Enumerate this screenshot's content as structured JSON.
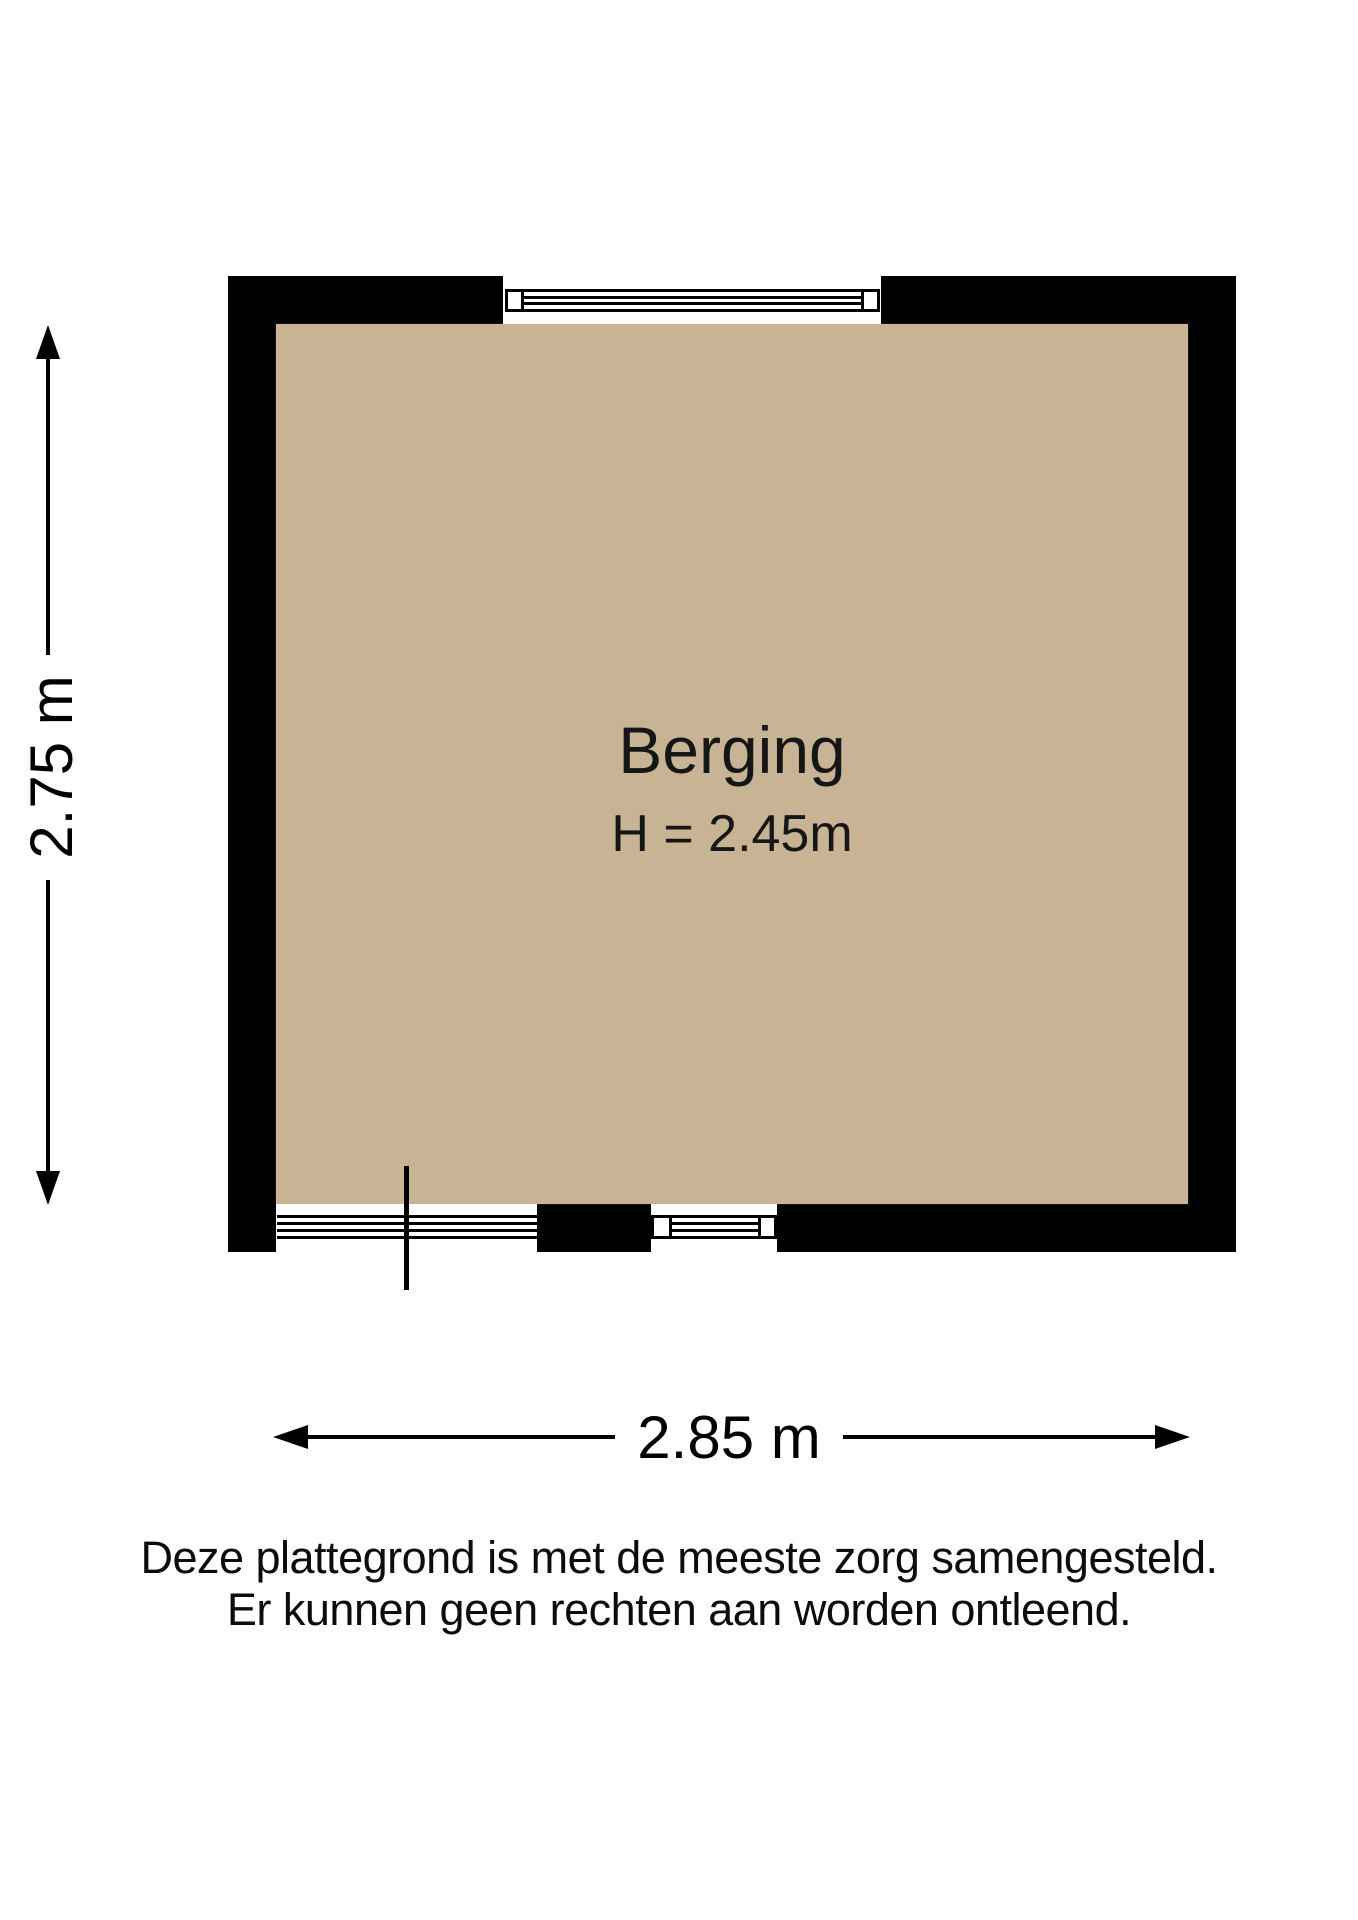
{
  "floorplan": {
    "room": {
      "name": "Berging",
      "ceiling_height": "H = 2.45m"
    },
    "dimensions": {
      "height": "2.75 m",
      "width": "2.85 m"
    },
    "disclaimer": [
      "Deze plattegrond is met de meeste zorg samengesteld.",
      "Er kunnen geen rechten aan worden ontleend."
    ],
    "colors": {
      "wall": "#000000",
      "floor": "#c8b494",
      "line": "#000000",
      "background": "#ffffff"
    }
  }
}
